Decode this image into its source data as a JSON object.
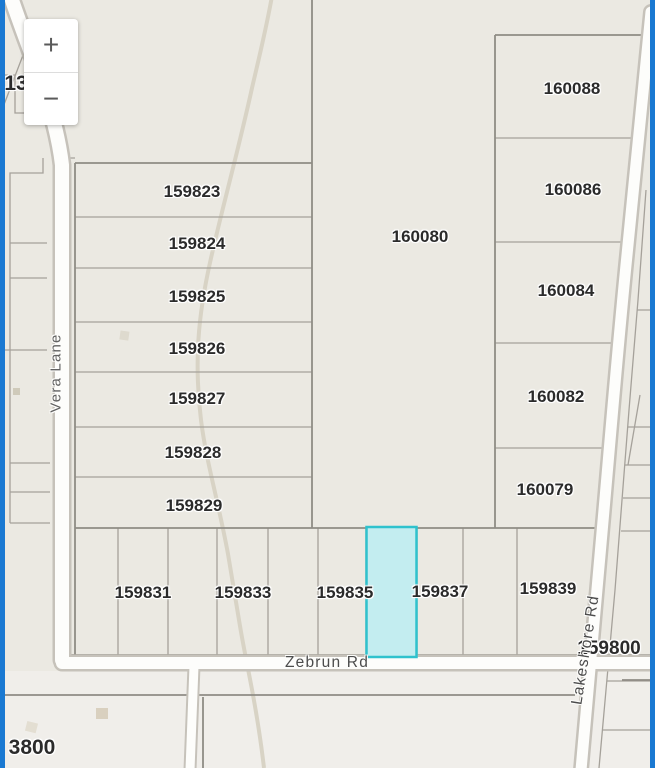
{
  "map": {
    "background_color": "#ebe9e2",
    "edge_line_color": "#1a79d2",
    "stream_color": "#d8d3c5",
    "controls": {
      "zoom_in_label": "+",
      "zoom_out_label": "−"
    },
    "selected_parcel": {
      "fill": "#c3edf0",
      "border": "#2fc2cd",
      "note": "unlabeled lot between 159835 and 159837"
    },
    "parcel_labels": [
      {
        "label": "159823"
      },
      {
        "label": "159824"
      },
      {
        "label": "159825"
      },
      {
        "label": "159826"
      },
      {
        "label": "159827"
      },
      {
        "label": "159828"
      },
      {
        "label": "159829"
      },
      {
        "label": "160080"
      },
      {
        "label": "160088"
      },
      {
        "label": "160086"
      },
      {
        "label": "160084"
      },
      {
        "label": "160082"
      },
      {
        "label": "160079"
      },
      {
        "label": "159831"
      },
      {
        "label": "159833"
      },
      {
        "label": "159835"
      },
      {
        "label": "159837"
      },
      {
        "label": "159839"
      },
      {
        "label": "159800"
      },
      {
        "label": "13"
      },
      {
        "label": "3800"
      }
    ],
    "road_labels": [
      {
        "label": "Ve"
      },
      {
        "label": "Vera Lane"
      },
      {
        "label": "Zebrun Rd"
      },
      {
        "label": "Lakeshore Rd"
      }
    ]
  }
}
